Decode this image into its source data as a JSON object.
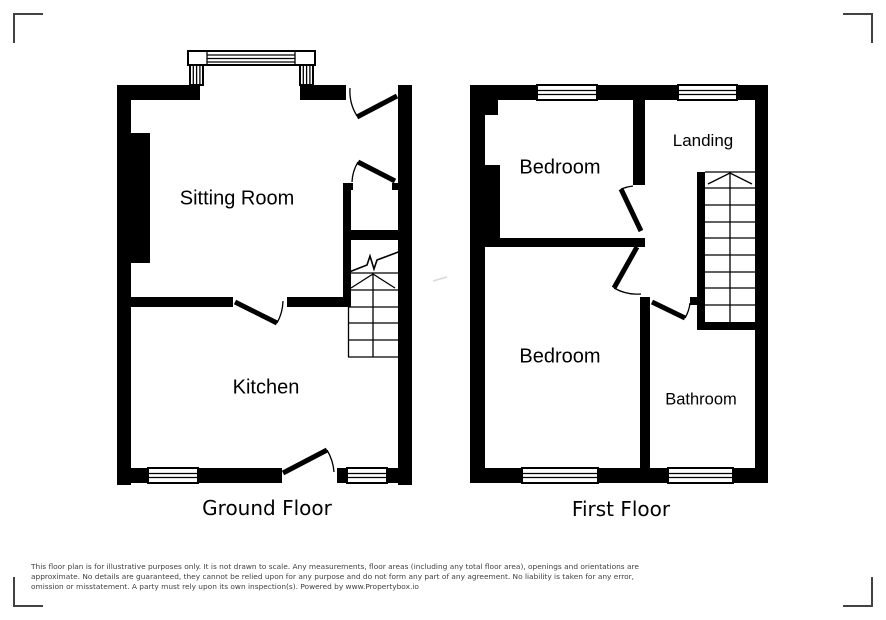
{
  "plans": {
    "ground": {
      "label": "Ground Floor",
      "rooms": {
        "sitting_room": "Sitting Room",
        "kitchen": "Kitchen"
      }
    },
    "first": {
      "label": "First Floor",
      "rooms": {
        "bedroom_front": "Bedroom",
        "landing": "Landing",
        "bedroom_back": "Bedroom",
        "bathroom": "Bathroom"
      }
    }
  },
  "disclaimer": {
    "lines": [
      "This floor plan is for illustrative purposes only. It is not drawn to scale. Any measurements, floor areas (including any total floor area), openings and orientations are",
      "approximate. No details are guaranteed, they cannot be relied upon for any purpose and do not form any part of any agreement. No liability is taken for any error,",
      "omission or misstatement. A party must rely upon its own inspection(s). Powered by www.Propertybox.io"
    ]
  },
  "colors": {
    "wall": "#000000",
    "label": "#000000",
    "disclaimer_text": "#3f3f3f",
    "corner_mark": "#424242",
    "faint_mark": "#d9d9d9"
  }
}
